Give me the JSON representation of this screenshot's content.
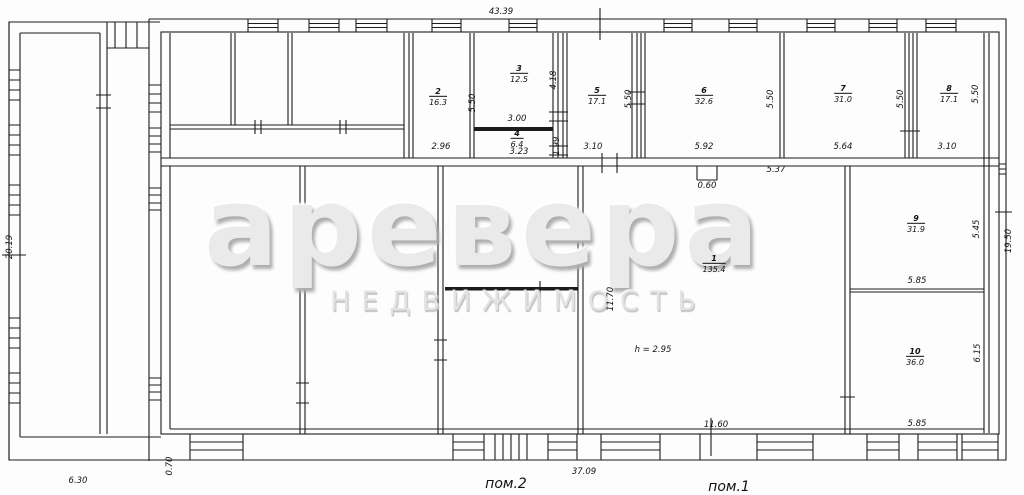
{
  "watermark": {
    "brand": "аревера",
    "subtitle": "НЕДВИЖИМОСТЬ"
  },
  "overall": {
    "top_width": "43.39",
    "bottom_width": "37.09",
    "left_height": "20.19",
    "right_height": "19.50",
    "wing_width": "6.30",
    "wing_offset": "0.70"
  },
  "annotations": {
    "pom1": "пом.1",
    "pom2": "пом.2",
    "ceiling_height": "h = 2.95",
    "notch_width": "0.60",
    "wall_span": "5.37"
  },
  "rooms": [
    {
      "number": "1",
      "area": "135.4",
      "width": "11.60",
      "height": "11.70"
    },
    {
      "number": "2",
      "area": "16.3",
      "width": "2.96",
      "height": "5.50"
    },
    {
      "number": "3",
      "area": "12.5",
      "width": "3.00",
      "height": "4.18"
    },
    {
      "number": "4",
      "area": "6.4",
      "width": "3.23",
      "height": "1.99"
    },
    {
      "number": "5",
      "area": "17.1",
      "width": "3.10",
      "height": "5.50"
    },
    {
      "number": "6",
      "area": "32.6",
      "width": "5.92",
      "height": "5.50"
    },
    {
      "number": "7",
      "area": "31.0",
      "width": "5.64",
      "height": "5.50"
    },
    {
      "number": "8",
      "area": "17.1",
      "width": "3.10",
      "height": "5.50"
    },
    {
      "number": "9",
      "area": "31.9",
      "width": "5.85",
      "height": "5.45"
    },
    {
      "number": "10",
      "area": "36.0",
      "width": "5.85",
      "height": "6.15"
    }
  ]
}
